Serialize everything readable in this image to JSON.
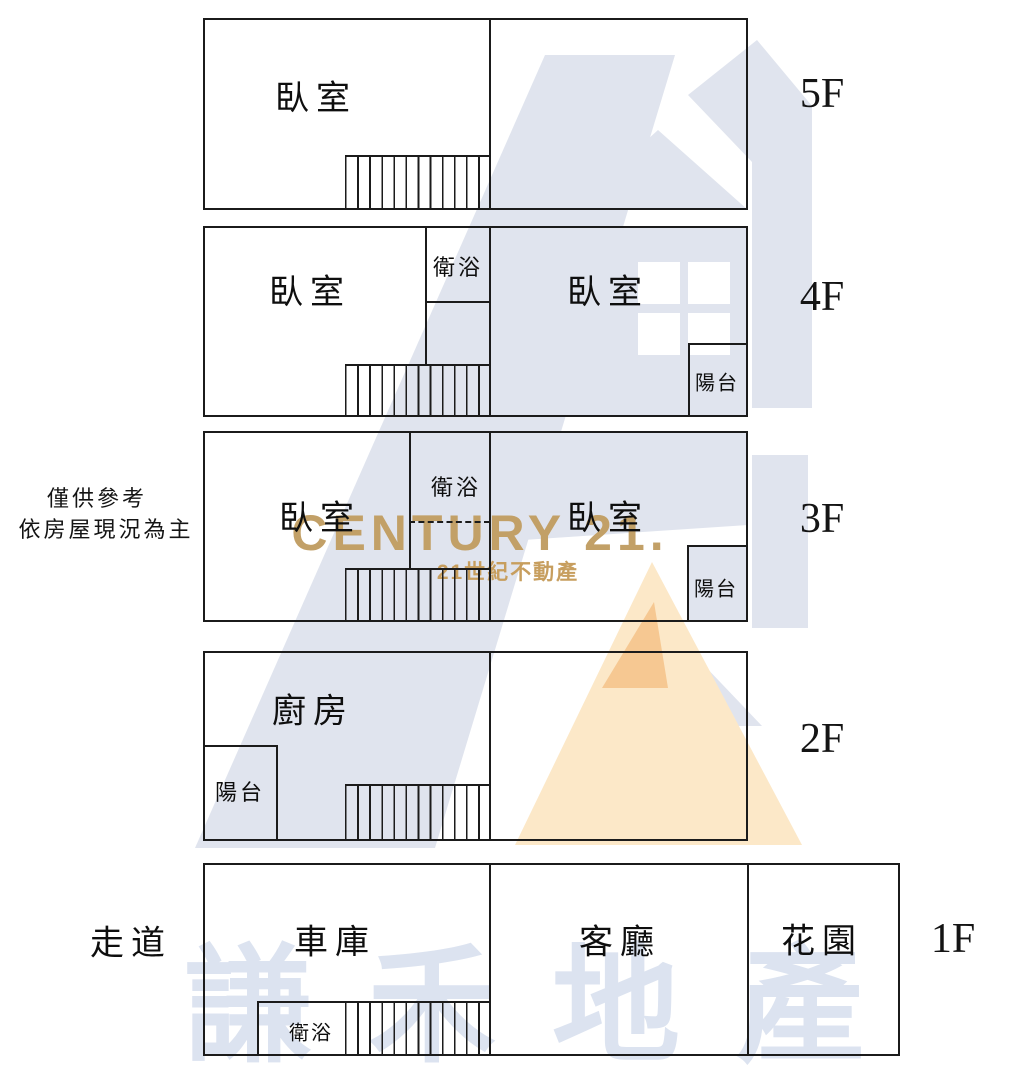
{
  "note": {
    "line1": "僅供參考",
    "line2": "依房屋現況為主"
  },
  "outside": {
    "walkway_label": "走道"
  },
  "floors": [
    {
      "label": "5F",
      "rooms": {
        "bedroom": "臥室"
      }
    },
    {
      "label": "4F",
      "rooms": {
        "bedroom_left": "臥室",
        "bath": "衛浴",
        "bedroom_right": "臥室",
        "balcony": "陽台"
      }
    },
    {
      "label": "3F",
      "rooms": {
        "bedroom_left": "臥室",
        "bath": "衛浴",
        "bedroom_right": "臥室",
        "balcony": "陽台"
      }
    },
    {
      "label": "2F",
      "rooms": {
        "kitchen": "廚房",
        "balcony": "陽台"
      }
    },
    {
      "label": "1F",
      "rooms": {
        "garage": "車庫",
        "living": "客廳",
        "garden": "花園",
        "bath": "衛浴"
      }
    }
  ],
  "watermark": {
    "brand": "CENTURY 21.",
    "tagline": "21世紀不動產",
    "company": "謙禾地產",
    "colors": {
      "gold": "#c2a067",
      "pale_blue": "#e0e4ee",
      "peach": "#fce8c8",
      "orange": "#f6c892",
      "company_blue": "#dce3f0",
      "white": "#ffffff"
    }
  }
}
